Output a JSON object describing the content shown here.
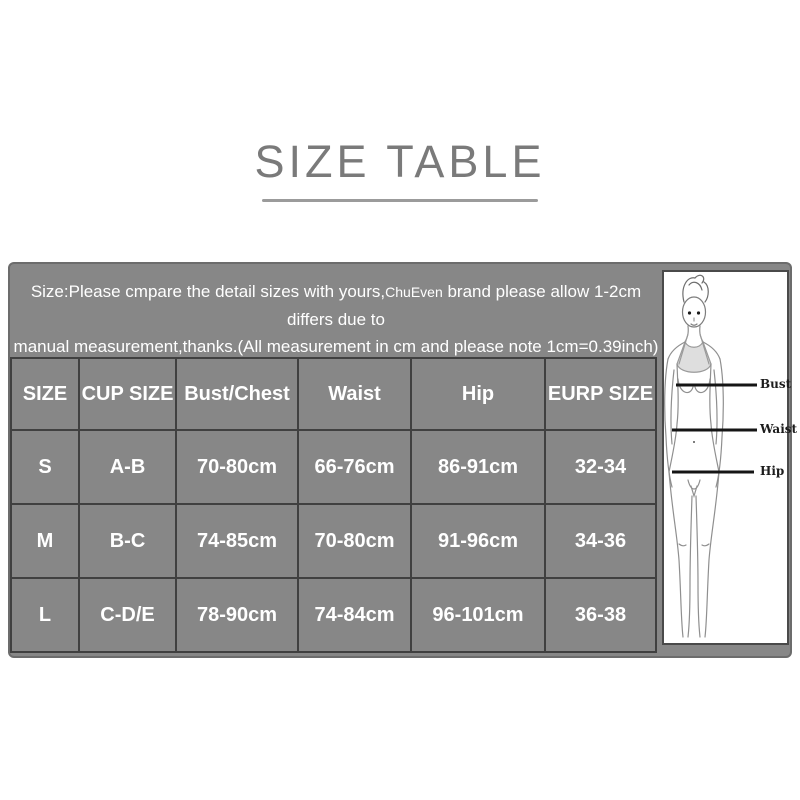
{
  "title": {
    "text": "SIZE TABLE"
  },
  "panel": {
    "background_color": "#878787",
    "grid_line_color": "#404040",
    "text_color": "#ffffff",
    "note_line1_pre": "Size:Please cmpare the detail sizes with yours,",
    "note_brand": "ChuEven",
    "note_line1_post": " brand please allow 1-2cm differs due to",
    "note_line2": "manual measurement,thanks.(All measurement in cm and please note 1cm=0.39inch)"
  },
  "size_table": {
    "headers": [
      "SIZE",
      "CUP SIZE",
      "Bust/Chest",
      "Waist",
      "Hip",
      "EURP SIZE"
    ],
    "rows": [
      [
        "S",
        "A-B",
        "70-80cm",
        "66-76cm",
        "86-91cm",
        "32-34"
      ],
      [
        "M",
        "B-C",
        "74-85cm",
        "70-80cm",
        "91-96cm",
        "34-36"
      ],
      [
        "L",
        "C-D/E",
        "78-90cm",
        "74-84cm",
        "96-101cm",
        "36-38"
      ]
    ]
  },
  "figure": {
    "labels": {
      "bust": "Bust",
      "waist": "Waist",
      "hip": "Hip"
    }
  },
  "colors": {
    "title_gray": "#7a7a7a",
    "underline_gray": "#9b9b9b",
    "panel_gray": "#878787",
    "grid_dark": "#404040",
    "measure_line": "#151515"
  }
}
